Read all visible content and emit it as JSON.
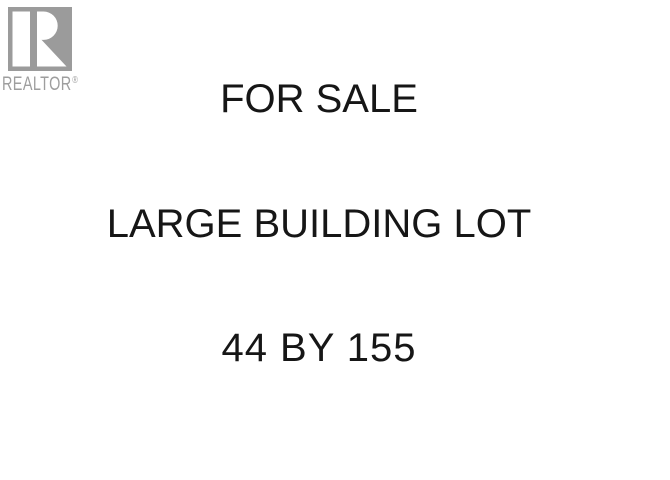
{
  "page": {
    "background_color": "#ffffff"
  },
  "logo": {
    "wordmark": "REALTOR",
    "registered_mark": "®",
    "square_color": "#9b9b9b",
    "glyph_color": "#ffffff",
    "wordmark_color": "#9e9e9e"
  },
  "sign": {
    "text_color": "#161616",
    "lines": [
      "FOR SALE",
      "LARGE BUILDING LOT",
      "44 BY 155"
    ]
  }
}
